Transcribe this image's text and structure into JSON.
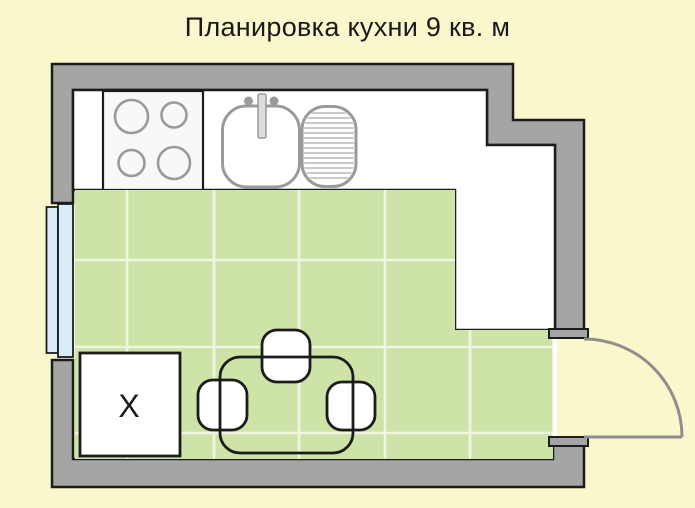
{
  "title": {
    "text": "Планировка кухни 9 кв. м"
  },
  "plan": {
    "fridge_label": "Х",
    "elements": [
      "stove-4-burners",
      "sink-with-faucet",
      "drainboard",
      "countertop",
      "window-double-pane",
      "refrigerator",
      "dining-table",
      "three-chairs",
      "door-swing",
      "green-tiled-floor"
    ]
  },
  "colors": {
    "background": "#fbf7cd",
    "wall": "#a5a5a5",
    "outline": "#1c1c1c",
    "floor": "#cde3a8",
    "grout": "#eff5e1",
    "window": "#d9edf8",
    "appliance": "#9a9a9a",
    "door": "#8e8e8e",
    "counter": "#ffffff"
  }
}
